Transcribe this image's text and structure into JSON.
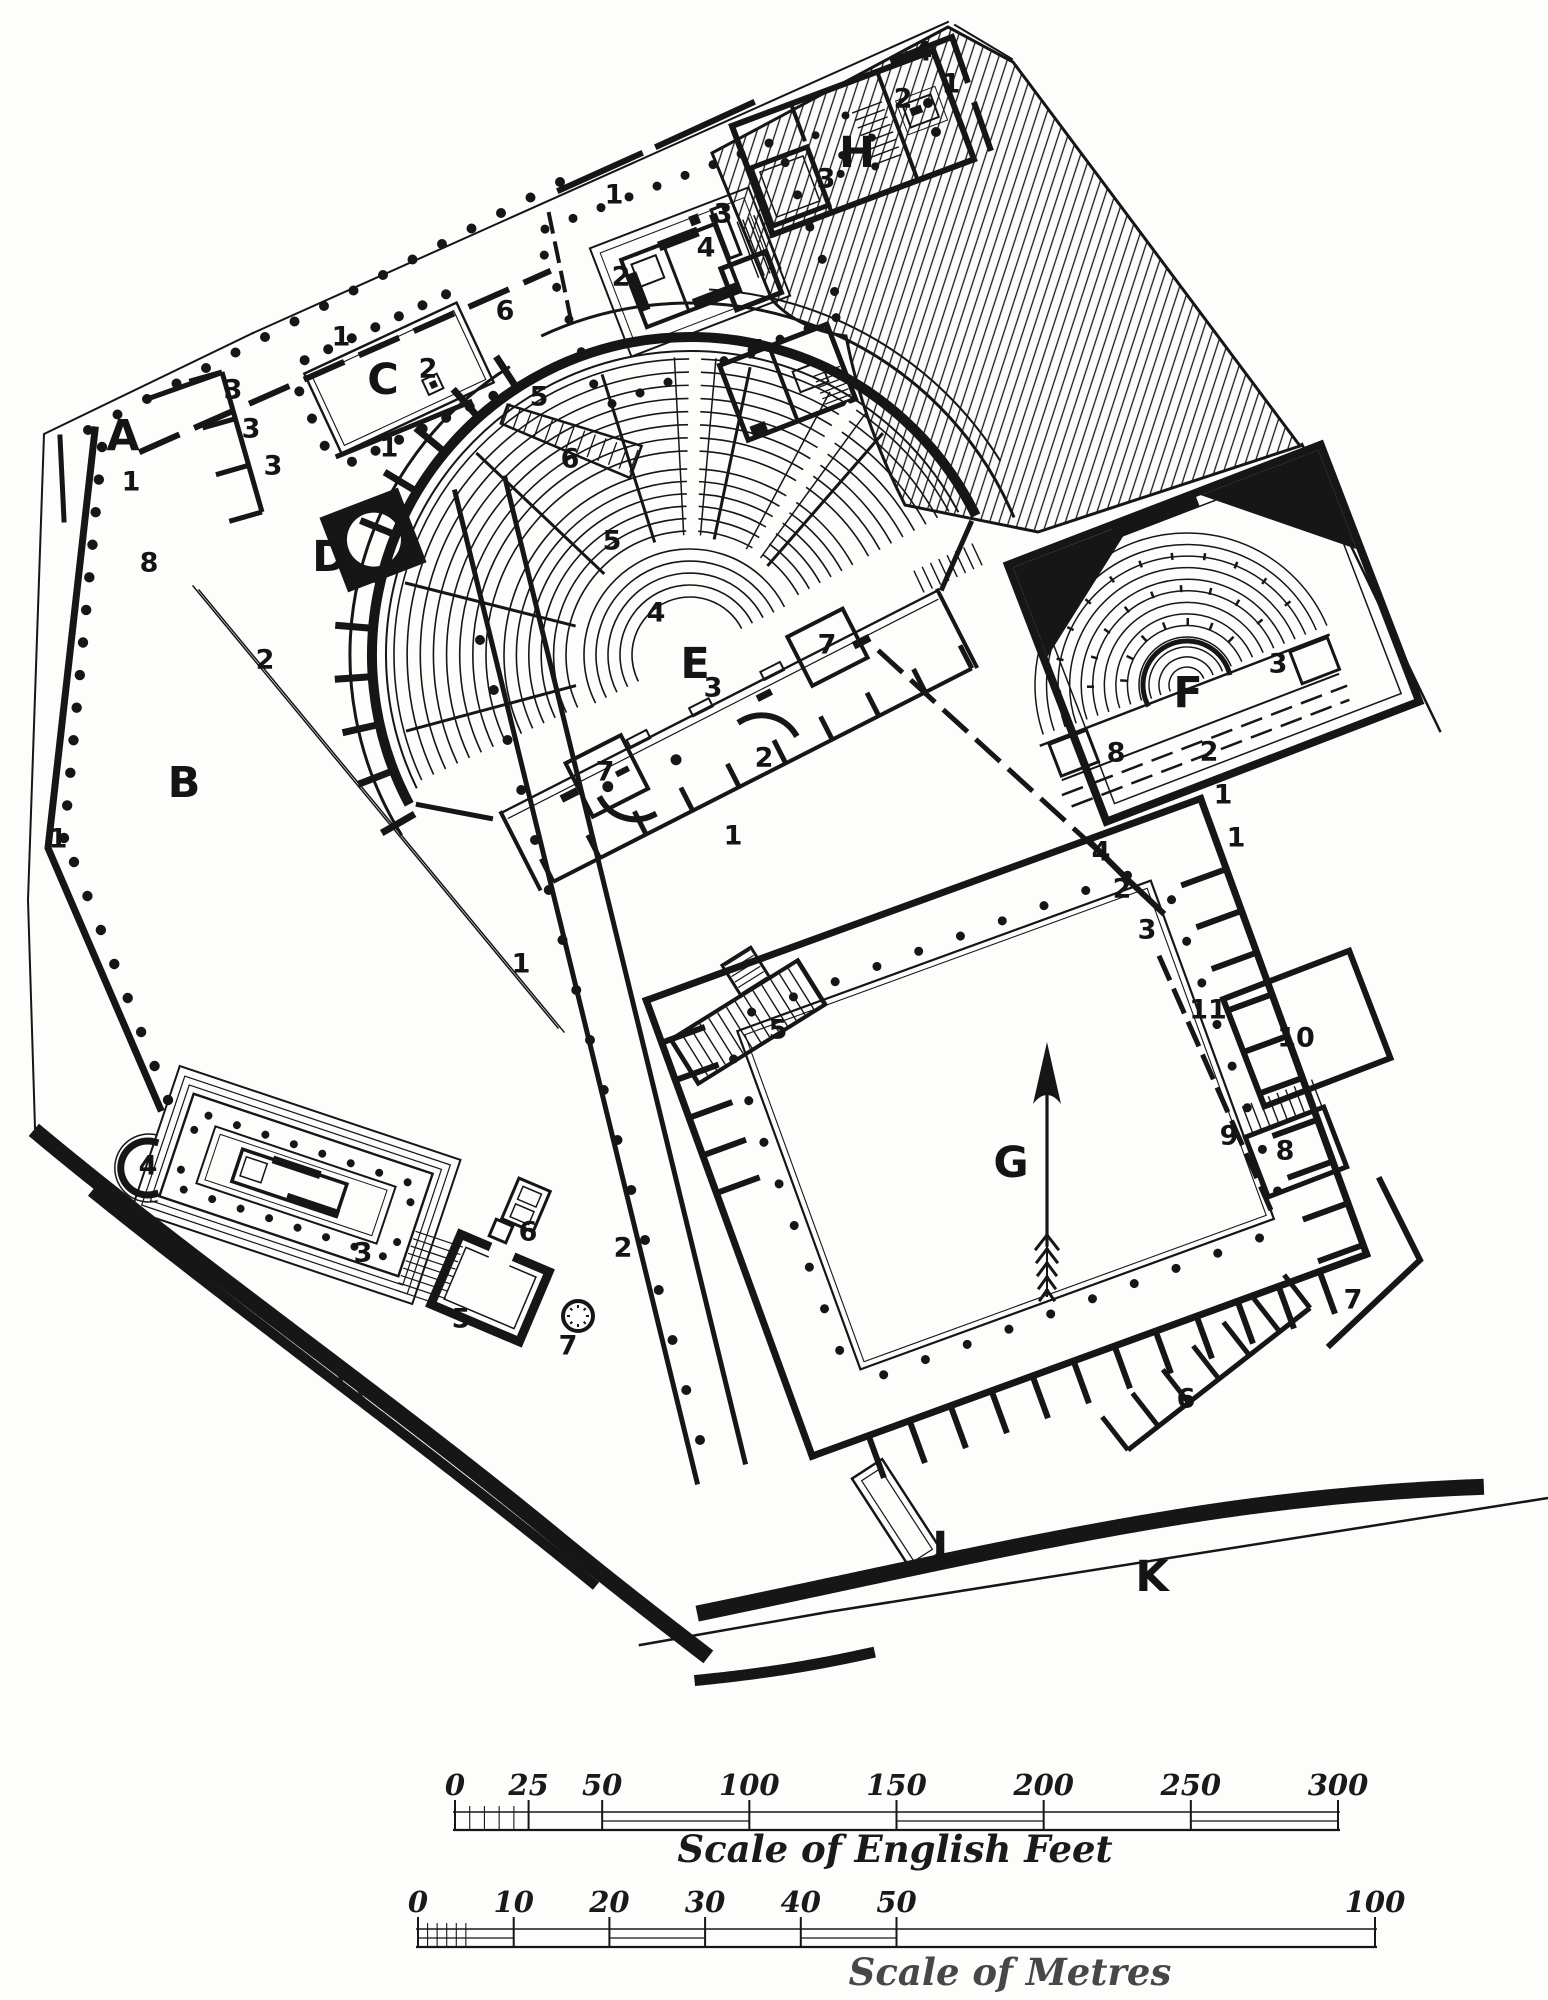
{
  "palette": {
    "ink": "#161616",
    "paper": "#fdfdfc"
  },
  "plan": {
    "letters": [
      {
        "text": "A",
        "x": 123,
        "y": 436
      },
      {
        "text": "B",
        "x": 184,
        "y": 783
      },
      {
        "text": "C",
        "x": 383,
        "y": 380
      },
      {
        "text": "D",
        "x": 330,
        "y": 557
      },
      {
        "text": "E",
        "x": 695,
        "y": 664
      },
      {
        "text": "F",
        "x": 1188,
        "y": 693
      },
      {
        "text": "G",
        "x": 1011,
        "y": 1163
      },
      {
        "text": "H",
        "x": 857,
        "y": 153
      },
      {
        "text": "K",
        "x": 1152,
        "y": 1577
      },
      {
        "text": "L",
        "x": 946,
        "y": 1548
      }
    ],
    "numbers": [
      {
        "text": "4",
        "x": 923,
        "y": 52
      },
      {
        "text": "1",
        "x": 951,
        "y": 84
      },
      {
        "text": "2",
        "x": 903,
        "y": 99
      },
      {
        "text": "3",
        "x": 826,
        "y": 179
      },
      {
        "text": "1",
        "x": 614,
        "y": 195
      },
      {
        "text": "3",
        "x": 723,
        "y": 214
      },
      {
        "text": "4",
        "x": 706,
        "y": 248
      },
      {
        "text": "2",
        "x": 621,
        "y": 277
      },
      {
        "text": "6",
        "x": 505,
        "y": 311
      },
      {
        "text": "7",
        "x": 754,
        "y": 350
      },
      {
        "text": "5",
        "x": 539,
        "y": 397
      },
      {
        "text": "1",
        "x": 341,
        "y": 337
      },
      {
        "text": "2",
        "x": 428,
        "y": 369
      },
      {
        "text": "1",
        "x": 389,
        "y": 448
      },
      {
        "text": "3",
        "x": 233,
        "y": 390
      },
      {
        "text": "3",
        "x": 251,
        "y": 429
      },
      {
        "text": "3",
        "x": 273,
        "y": 466
      },
      {
        "text": "1",
        "x": 131,
        "y": 482
      },
      {
        "text": "8",
        "x": 149,
        "y": 563
      },
      {
        "text": "2",
        "x": 265,
        "y": 660
      },
      {
        "text": "1",
        "x": 58,
        "y": 839
      },
      {
        "text": "6",
        "x": 570,
        "y": 459
      },
      {
        "text": "5",
        "x": 612,
        "y": 541
      },
      {
        "text": "4",
        "x": 656,
        "y": 613
      },
      {
        "text": "3",
        "x": 713,
        "y": 688
      },
      {
        "text": "7",
        "x": 827,
        "y": 645
      },
      {
        "text": "7",
        "x": 605,
        "y": 772
      },
      {
        "text": "2",
        "x": 764,
        "y": 758
      },
      {
        "text": "1",
        "x": 733,
        "y": 836
      },
      {
        "text": "3",
        "x": 1278,
        "y": 664
      },
      {
        "text": "8",
        "x": 1116,
        "y": 753
      },
      {
        "text": "2",
        "x": 1209,
        "y": 752
      },
      {
        "text": "1",
        "x": 1223,
        "y": 795
      },
      {
        "text": "1",
        "x": 1236,
        "y": 838
      },
      {
        "text": "4",
        "x": 1101,
        "y": 852
      },
      {
        "text": "2",
        "x": 1122,
        "y": 889
      },
      {
        "text": "3",
        "x": 1147,
        "y": 930
      },
      {
        "text": "11",
        "x": 1208,
        "y": 1010
      },
      {
        "text": "10",
        "x": 1296,
        "y": 1038
      },
      {
        "text": "9",
        "x": 1229,
        "y": 1136
      },
      {
        "text": "8",
        "x": 1285,
        "y": 1151
      },
      {
        "text": "7",
        "x": 1353,
        "y": 1300
      },
      {
        "text": "6",
        "x": 1186,
        "y": 1399
      },
      {
        "text": "5",
        "x": 778,
        "y": 1030
      },
      {
        "text": "1",
        "x": 521,
        "y": 964
      },
      {
        "text": "2",
        "x": 623,
        "y": 1248
      },
      {
        "text": "4",
        "x": 148,
        "y": 1166
      },
      {
        "text": "3",
        "x": 363,
        "y": 1253
      },
      {
        "text": "6",
        "x": 528,
        "y": 1232
      },
      {
        "text": "5",
        "x": 461,
        "y": 1319
      },
      {
        "text": "7",
        "x": 568,
        "y": 1346
      }
    ],
    "north_arrow": {
      "symbol": "north-arrow"
    }
  },
  "scale_feet": {
    "caption": "Scale of English Feet",
    "unit_max": 300,
    "ticks": [
      {
        "value": 0,
        "label": "0"
      },
      {
        "value": 25,
        "label": "25"
      },
      {
        "value": 50,
        "label": "50"
      },
      {
        "value": 100,
        "label": "100"
      },
      {
        "value": 150,
        "label": "150"
      },
      {
        "value": 200,
        "label": "200"
      },
      {
        "value": 250,
        "label": "250"
      },
      {
        "value": 300,
        "label": "300"
      }
    ]
  },
  "scale_metres": {
    "caption": "Scale of Metres",
    "unit_max": 100,
    "ticks": [
      {
        "value": 0,
        "label": "0"
      },
      {
        "value": 10,
        "label": "10"
      },
      {
        "value": 20,
        "label": "20"
      },
      {
        "value": 30,
        "label": "30"
      },
      {
        "value": 40,
        "label": "40"
      },
      {
        "value": 50,
        "label": "50"
      },
      {
        "value": 100,
        "label": "100"
      }
    ]
  }
}
